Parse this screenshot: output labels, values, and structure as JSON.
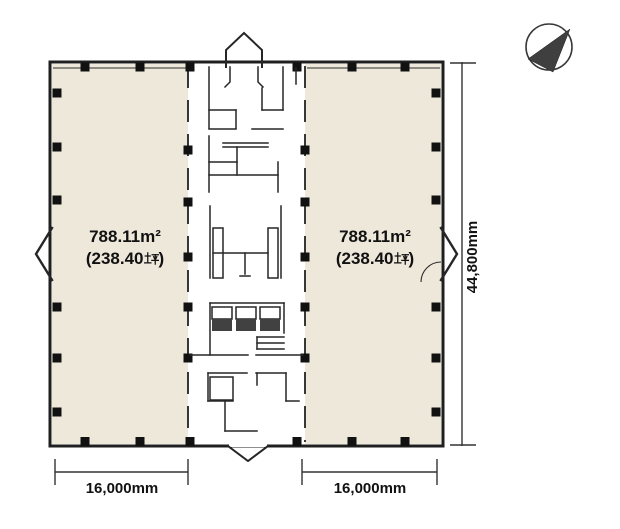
{
  "page": {
    "background": "#ffffff"
  },
  "plan": {
    "units": {
      "left": {
        "area_sqm": "788.11m²",
        "tsubo_prefix": "(238.40",
        "tsubo_char": "坪",
        "tsubo_suffix": ")",
        "full_label": "788.11m² (238.40坪)"
      },
      "right": {
        "area_sqm": "788.11m²",
        "tsubo_prefix": "(238.40",
        "tsubo_char": "坪",
        "tsubo_suffix": ")",
        "full_label": "788.11m² (238.40坪)"
      }
    },
    "dimensions": {
      "vertical": "44,800mm",
      "bottom_left": "16,000mm",
      "bottom_right": "16,000mm"
    },
    "colors": {
      "unit_fill": "#eee8db",
      "line": "#262626",
      "toilet_dark": "#414141",
      "toilet_light": "#c9c5bd"
    },
    "compass": {
      "description": "north arrow pointing upper-right"
    }
  }
}
